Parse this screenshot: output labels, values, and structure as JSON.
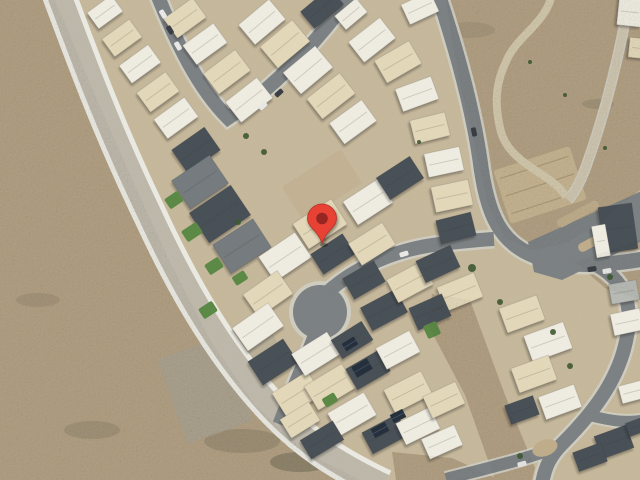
{
  "map": {
    "view": "satellite",
    "colors": {
      "ground": "#c7b99c",
      "desert": "#b2a083",
      "road_main": "#beb9ab",
      "road_main_casing": "#ecebe3",
      "street": "#7d8284",
      "street_casing": "#d0cdc1",
      "light_road": "#cfc6b0",
      "trail": "#d2c8ac",
      "lawn": "#5c8a46",
      "tree": "#3e5a33",
      "solar": "#26303d",
      "car_w": "#e9e9e7",
      "car_d": "#3a3f46",
      "stain": "#3f4436",
      "median": "#c0ae8c",
      "house_palette": {
        "b": "#e4d9ba",
        "c": "#f0ede2",
        "d": "#4a5158",
        "m": "#767c7f",
        "g": "#b9bcb6",
        "t": "#cdbd9c"
      }
    },
    "desert_polys": [
      "0,0 55,0 95,95 130,175 170,262 210,340 255,405 305,452 360,480 0,480",
      "446,0 640,0 640,190 600,222 565,244 532,250 505,238 488,205 478,160 462,92 452,40",
      "575,262 640,240 640,300 605,288",
      "432,294 470,300 505,395 535,468 532,480 495,480 465,395 428,325",
      "392,452 452,458 500,480 396,480"
    ],
    "patches": [
      {
        "x": 205,
        "y": 390,
        "w": 70,
        "h": 90,
        "rot": -20,
        "fill": "#a9a191",
        "opacity": 0.85,
        "lines": false
      },
      {
        "x": 256,
        "y": 350,
        "w": 44,
        "h": 54,
        "rot": -20,
        "fill": "#b3ab97",
        "opacity": 0.6,
        "lines": false
      },
      {
        "x": 322,
        "y": 185,
        "w": 70,
        "h": 40,
        "rot": -33,
        "fill": "#c4b394",
        "opacity": 1,
        "lines": false
      },
      {
        "x": 540,
        "y": 185,
        "w": 80,
        "h": 56,
        "rot": -18,
        "fill": "#c6b491",
        "opacity": 1,
        "lines": true
      }
    ],
    "roads": [
      {
        "name": "main-road",
        "path": "M 58,-8 C 84,62 110,132 150,215 C 186,293 226,360 276,412 C 306,443 336,463 384,486",
        "w": 24,
        "cw": 34,
        "color": "road_main",
        "casing": "road_main_casing"
      },
      {
        "name": "street-top-v",
        "path": "M 157,-6 C 176,42 198,88 228,118 C 262,96 305,58 352,-6",
        "w": 14,
        "cw": 19,
        "color": "street",
        "casing": "street_casing"
      },
      {
        "name": "street-right-curve",
        "path": "M 438,-6 C 455,45 472,105 480,160 C 487,215 500,245 540,258 C 570,267 602,266 644,259",
        "w": 15,
        "cw": 20,
        "color": "street",
        "casing": "street_casing"
      },
      {
        "name": "street-culdesac",
        "path": "M 316,304 C 344,272 390,250 440,244 C 458,242 476,240 494,239",
        "w": 14,
        "cw": 19,
        "color": "street",
        "casing": "street_casing"
      },
      {
        "name": "street-culdesac-south",
        "path": "M 318,326 C 306,358 292,390 279,424",
        "w": 13,
        "cw": 18,
        "color": "street",
        "casing": "street_casing"
      },
      {
        "name": "street-bottom-right",
        "path": "M 598,266 C 622,280 632,300 628,330 C 622,375 596,410 562,444 C 551,455 545,466 542,484",
        "w": 14,
        "cw": 19,
        "color": "street",
        "casing": "street_casing"
      },
      {
        "name": "street-bottom-branch",
        "path": "M 560,446 C 530,458 496,466 446,479",
        "w": 12,
        "cw": 16,
        "color": "street",
        "casing": "street_casing"
      },
      {
        "name": "street-right-stub",
        "path": "M 592,416 C 612,421 626,423 644,420",
        "w": 11,
        "cw": 15,
        "color": "street",
        "casing": "street_casing"
      },
      {
        "name": "light-road-top-right",
        "path": "M 630,-6 C 621,48 606,110 589,158 C 583,176 577,190 568,200",
        "w": 8,
        "cw": 11,
        "color": "light_road",
        "casing": "street_casing"
      },
      {
        "name": "walking-trail",
        "path": "M 552,-6 C 546,24 516,36 506,62 C 493,88 496,112 501,132 C 506,150 522,162 541,174 C 553,182 561,188 566,197",
        "w": 6,
        "cw": 8,
        "color": "trail",
        "casing": "trail"
      }
    ],
    "culdesac_bulb": {
      "x": 320,
      "y": 312,
      "r": 27,
      "cr": 31
    },
    "divided_road": {
      "poly": "528,242 644,190 644,240 562,280 534,272"
    },
    "medians": [
      {
        "x": 578,
        "y": 214,
        "w": 46,
        "h": 9,
        "rot": -28
      },
      {
        "x": 600,
        "y": 238,
        "w": 48,
        "h": 9,
        "rot": -28
      }
    ],
    "island": {
      "x": 545,
      "y": 448,
      "rx": 13,
      "ry": 8,
      "rot": -20
    },
    "houses": [
      [
        105,
        12,
        30,
        20,
        -36,
        "c"
      ],
      [
        122,
        38,
        34,
        22,
        -36,
        "b"
      ],
      [
        140,
        64,
        36,
        22,
        -36,
        "c"
      ],
      [
        158,
        92,
        36,
        24,
        -36,
        "b"
      ],
      [
        176,
        118,
        38,
        24,
        -36,
        "c"
      ],
      [
        196,
        150,
        40,
        28,
        -35,
        "d"
      ],
      [
        200,
        182,
        46,
        34,
        -34,
        "m"
      ],
      [
        220,
        214,
        50,
        36,
        -34,
        "d"
      ],
      [
        242,
        246,
        48,
        34,
        -33,
        "m"
      ],
      [
        185,
        18,
        36,
        24,
        -36,
        "b"
      ],
      [
        205,
        44,
        38,
        24,
        -36,
        "c"
      ],
      [
        227,
        72,
        40,
        26,
        -37,
        "b"
      ],
      [
        249,
        100,
        40,
        26,
        -38,
        "c"
      ],
      [
        262,
        22,
        40,
        26,
        -40,
        "c"
      ],
      [
        285,
        44,
        42,
        28,
        -40,
        "b"
      ],
      [
        308,
        70,
        42,
        28,
        -40,
        "c"
      ],
      [
        331,
        96,
        42,
        26,
        -38,
        "b"
      ],
      [
        353,
        122,
        40,
        26,
        -36,
        "c"
      ],
      [
        322,
        8,
        38,
        22,
        -40,
        "d"
      ],
      [
        351,
        14,
        28,
        18,
        -40,
        "c"
      ],
      [
        372,
        40,
        40,
        26,
        -38,
        "c"
      ],
      [
        398,
        62,
        40,
        26,
        -30,
        "b"
      ],
      [
        420,
        8,
        32,
        22,
        -25,
        "c"
      ],
      [
        417,
        94,
        38,
        24,
        -20,
        "c"
      ],
      [
        430,
        128,
        36,
        24,
        -14,
        "b"
      ],
      [
        444,
        162,
        36,
        24,
        -12,
        "c"
      ],
      [
        452,
        196,
        38,
        26,
        -12,
        "b"
      ],
      [
        456,
        228,
        36,
        24,
        -14,
        "d"
      ],
      [
        320,
        224,
        46,
        30,
        -33,
        "b"
      ],
      [
        368,
        202,
        42,
        28,
        -33,
        "c"
      ],
      [
        400,
        178,
        40,
        26,
        -33,
        "d"
      ],
      [
        285,
        257,
        44,
        30,
        -34,
        "c"
      ],
      [
        333,
        254,
        38,
        24,
        -33,
        "d"
      ],
      [
        372,
        244,
        40,
        26,
        -32,
        "b"
      ],
      [
        268,
        294,
        42,
        28,
        -35,
        "b"
      ],
      [
        258,
        327,
        44,
        28,
        -35,
        "c"
      ],
      [
        273,
        362,
        42,
        28,
        -33,
        "d"
      ],
      [
        297,
        394,
        42,
        28,
        -32,
        "b"
      ],
      [
        364,
        280,
        36,
        24,
        -30,
        "d"
      ],
      [
        384,
        310,
        40,
        26,
        -28,
        "d"
      ],
      [
        410,
        282,
        40,
        26,
        -28,
        "b"
      ],
      [
        438,
        264,
        38,
        24,
        -25,
        "d"
      ],
      [
        460,
        292,
        40,
        26,
        -22,
        "b"
      ],
      [
        430,
        312,
        36,
        24,
        -24,
        "d"
      ],
      [
        316,
        354,
        42,
        26,
        -32,
        "c"
      ],
      [
        352,
        340,
        36,
        22,
        -32,
        "d"
      ],
      [
        330,
        387,
        44,
        28,
        -31,
        "b"
      ],
      [
        368,
        370,
        38,
        24,
        -30,
        "d"
      ],
      [
        398,
        350,
        38,
        24,
        -28,
        "c"
      ],
      [
        408,
        392,
        42,
        26,
        -27,
        "b"
      ],
      [
        352,
        414,
        42,
        26,
        -30,
        "c"
      ],
      [
        385,
        434,
        40,
        24,
        -28,
        "d"
      ],
      [
        322,
        440,
        38,
        22,
        -31,
        "d"
      ],
      [
        418,
        426,
        38,
        24,
        -26,
        "c"
      ],
      [
        444,
        400,
        36,
        24,
        -25,
        "b"
      ],
      [
        300,
        420,
        34,
        22,
        -32,
        "b"
      ],
      [
        442,
        442,
        36,
        22,
        -24,
        "c"
      ],
      [
        522,
        314,
        40,
        26,
        -20,
        "b"
      ],
      [
        548,
        342,
        42,
        28,
        -20,
        "c"
      ],
      [
        534,
        374,
        40,
        26,
        -20,
        "b"
      ],
      [
        560,
        402,
        38,
        24,
        -20,
        "c"
      ],
      [
        522,
        410,
        30,
        20,
        -20,
        "d"
      ],
      [
        618,
        228,
        34,
        46,
        -8,
        "d"
      ],
      [
        601,
        241,
        14,
        32,
        -10,
        "c"
      ],
      [
        624,
        292,
        28,
        20,
        -10,
        "g"
      ],
      [
        627,
        322,
        30,
        22,
        -12,
        "c"
      ],
      [
        632,
        392,
        24,
        18,
        -15,
        "c"
      ],
      [
        614,
        442,
        34,
        24,
        -20,
        "d"
      ],
      [
        636,
        427,
        18,
        14,
        -20,
        "d"
      ],
      [
        590,
        457,
        30,
        20,
        -20,
        "d"
      ],
      [
        630,
        12,
        24,
        28,
        6,
        "c"
      ],
      [
        637,
        48,
        16,
        20,
        6,
        "b"
      ]
    ],
    "lawns": [
      [
        174,
        200,
        16,
        12,
        -34
      ],
      [
        192,
        232,
        18,
        13,
        -34
      ],
      [
        214,
        266,
        16,
        12,
        -33
      ],
      [
        208,
        310,
        16,
        12,
        -33
      ],
      [
        432,
        330,
        14,
        14,
        -24
      ],
      [
        330,
        400,
        14,
        10,
        -31
      ],
      [
        240,
        278,
        14,
        10,
        -33
      ]
    ],
    "trees": [
      [
        246,
        136,
        3
      ],
      [
        264,
        152,
        3
      ],
      [
        472,
        268,
        4
      ],
      [
        500,
        302,
        3
      ],
      [
        553,
        332,
        3
      ],
      [
        610,
        277,
        3
      ],
      [
        520,
        456,
        3
      ],
      [
        419,
        142,
        2
      ],
      [
        570,
        366,
        3
      ],
      [
        238,
        222,
        3
      ],
      [
        565,
        95,
        2
      ],
      [
        605,
        148,
        2
      ],
      [
        530,
        62,
        2
      ]
    ],
    "solar_panels": [
      [
        362,
        368,
        18,
        12,
        -30
      ],
      [
        380,
        430,
        16,
        10,
        -28
      ],
      [
        350,
        344,
        14,
        9,
        -32
      ],
      [
        398,
        416,
        14,
        9,
        -27
      ]
    ],
    "cars": [
      [
        163,
        14,
        59,
        "w"
      ],
      [
        170,
        30,
        59,
        "d"
      ],
      [
        178,
        46,
        59,
        "w"
      ],
      [
        263,
        106,
        -42,
        "w"
      ],
      [
        279,
        93,
        -42,
        "d"
      ],
      [
        474,
        132,
        78,
        "d"
      ],
      [
        592,
        269,
        -10,
        "d"
      ],
      [
        607,
        271,
        -10,
        "w"
      ],
      [
        404,
        254,
        -18,
        "w"
      ],
      [
        522,
        464,
        -15,
        "w"
      ]
    ],
    "stains": [
      [
        300,
        462,
        30,
        10,
        0.3
      ],
      [
        242,
        441,
        38,
        12,
        0.18
      ],
      [
        92,
        430,
        28,
        9,
        0.15
      ],
      [
        38,
        300,
        22,
        7,
        0.12
      ],
      [
        142,
        62,
        18,
        6,
        0.12
      ],
      [
        470,
        30,
        25,
        8,
        0.1
      ],
      [
        598,
        104,
        16,
        5,
        0.14
      ]
    ],
    "marker": {
      "x": 322,
      "y": 243,
      "body": "#E84335",
      "outline": "#B52F24",
      "dot": "#962820"
    }
  }
}
